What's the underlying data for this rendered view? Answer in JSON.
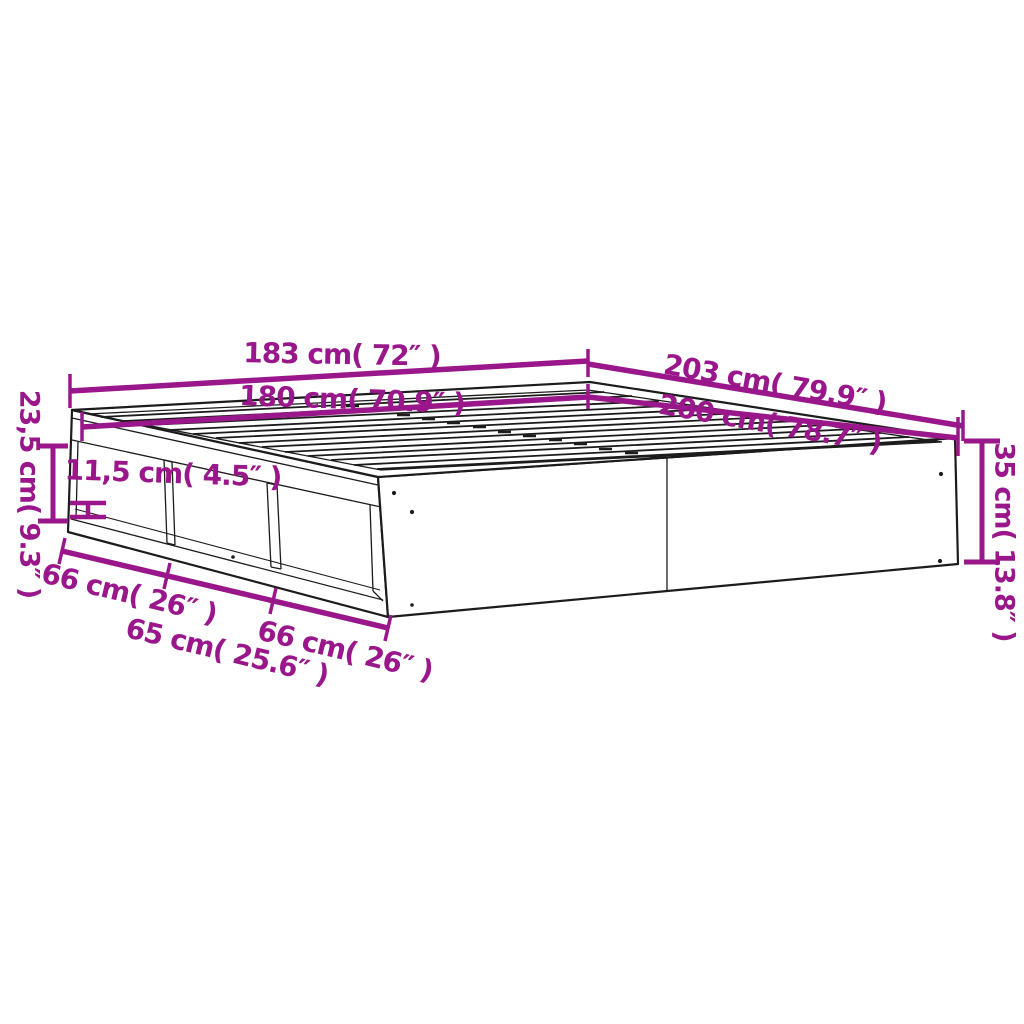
{
  "diagram": {
    "type": "product-dimension-diagram",
    "subject": "bed frame with side storage shelves, isometric line drawing",
    "colors": {
      "accent": "#9A178B",
      "line": "#1C1C1C",
      "background": "#FFFFFF"
    },
    "labels": {
      "width_outer": {
        "text": "183 cm( 72″ )"
      },
      "width_inner": {
        "text": "180 cm( 70.9″ )"
      },
      "length_outer": {
        "text": "203 cm( 79.9″ )"
      },
      "length_inner": {
        "text": "200 cm( 78.7″ )"
      },
      "height_left": {
        "text": "23,5 cm( 9.3″ )"
      },
      "height_right": {
        "text": "35 cm( 13.8″ )"
      },
      "shelf_opening": {
        "text": "11,5 cm( 4.5″ )"
      },
      "shelf_1": {
        "text": "66 cm( 26″ )"
      },
      "shelf_2": {
        "text": "65 cm( 25.6″ )"
      },
      "shelf_3": {
        "text": "66 cm( 26″ )"
      }
    }
  }
}
